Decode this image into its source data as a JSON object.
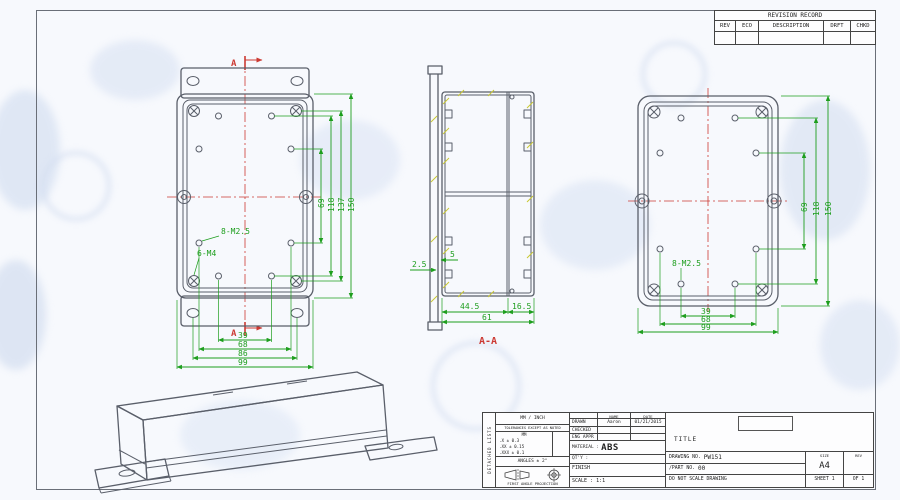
{
  "rev_table": {
    "title": "REVISION RECORD",
    "cols": [
      "REV",
      "ECO",
      "DESCRIPTION",
      "DRFT",
      "CHKD"
    ]
  },
  "front": {
    "section_mark": "A",
    "label_m25": "8-M2.5",
    "label_m4": "6-M4",
    "dims_right": [
      "69",
      "118",
      "137",
      "150"
    ],
    "dims_bottom": [
      "39",
      "68",
      "86",
      "99"
    ]
  },
  "section": {
    "label": "A-A",
    "dims_bottom": [
      "44.5",
      "16.5",
      "61"
    ],
    "dim_wall": "2.5",
    "dim_boss": "5"
  },
  "back": {
    "label_m25": "8-M2.5",
    "dims_right": [
      "69",
      "118",
      "150"
    ],
    "dims_bottom": [
      "39",
      "68",
      "99"
    ]
  },
  "tb": {
    "strip": "DETACHED LISTS",
    "mm_inch": "MM / INCH",
    "tol_title": "TOLERANCES EXCEPT AS NOTED",
    "tol_unit": "MM",
    "tol_rows": [
      ".X ± 0.3",
      ".XX ± 0.15",
      ".XXX ± 0.1"
    ],
    "angles": "ANGLES ± 2°",
    "projection": "FIRST ANGLE PROJECTION",
    "name_h": "NAME",
    "date_h": "DATE",
    "rows": [
      {
        "label": "DRAWN",
        "name": "Aaron",
        "date": "01/21/2015"
      },
      {
        "label": "CHECKED",
        "name": "",
        "date": ""
      },
      {
        "label": "ENG APPR",
        "name": "",
        "date": ""
      }
    ],
    "material_label": "MATERIAL :",
    "material_value": "ABS",
    "qty": "QT'Y :",
    "finish": "FINISH",
    "scale": "SCALE : 1:1",
    "title": "TITLE",
    "dwg_label": "DRAWING NO.",
    "dwg_no": "PW151",
    "part_label": "/PART  NO.",
    "part_no": "00",
    "size_h": "SIZE",
    "size_v": "A4",
    "rev_h": "REV",
    "dns": "DO NOT SCALE DRAWING",
    "sheet": "SHEET 1",
    "of": "OF 1"
  },
  "colors": {
    "dimension_green": "#1d9e1d",
    "centerline_red": "#cc3a33",
    "outline_gray": "#5a5f6a",
    "hatch_yellow": "#c9c930"
  }
}
